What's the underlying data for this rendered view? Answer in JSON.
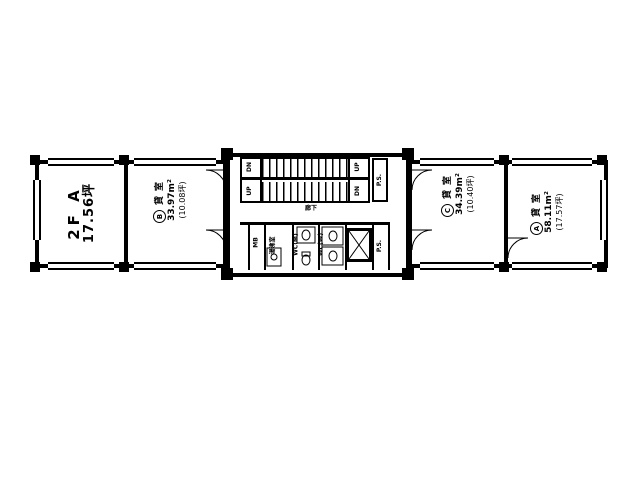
{
  "unit_label": {
    "line1": "2F A",
    "line2": "17.56坪"
  },
  "rooms": {
    "b": {
      "mark": "B",
      "type": "貸室",
      "area_m2": "33.97m²",
      "area_tsubo": "(10.08坪)"
    },
    "c": {
      "mark": "C",
      "type": "貸室",
      "area_m2": "34.39m²",
      "area_tsubo": "(10.40坪)"
    },
    "a": {
      "mark": "A",
      "type": "貸室",
      "area_m2": "58.11m²",
      "area_tsubo": "(17.57坪)"
    }
  },
  "core": {
    "stairs": {
      "left_top": "DN",
      "left_bottom": "UP",
      "right_top": "UP",
      "right_bottom": "DN"
    },
    "corridor_label": "廊下",
    "mb_label": "MB",
    "kitchenette_label": "湯沸室",
    "wc_m_label": "WC(M)",
    "wc_w_label": "WC(W)",
    "ps_upper_label": "P.S.",
    "ps_lower_label": "P.S."
  },
  "colors": {
    "line": "#000000",
    "background": "#ffffff"
  }
}
